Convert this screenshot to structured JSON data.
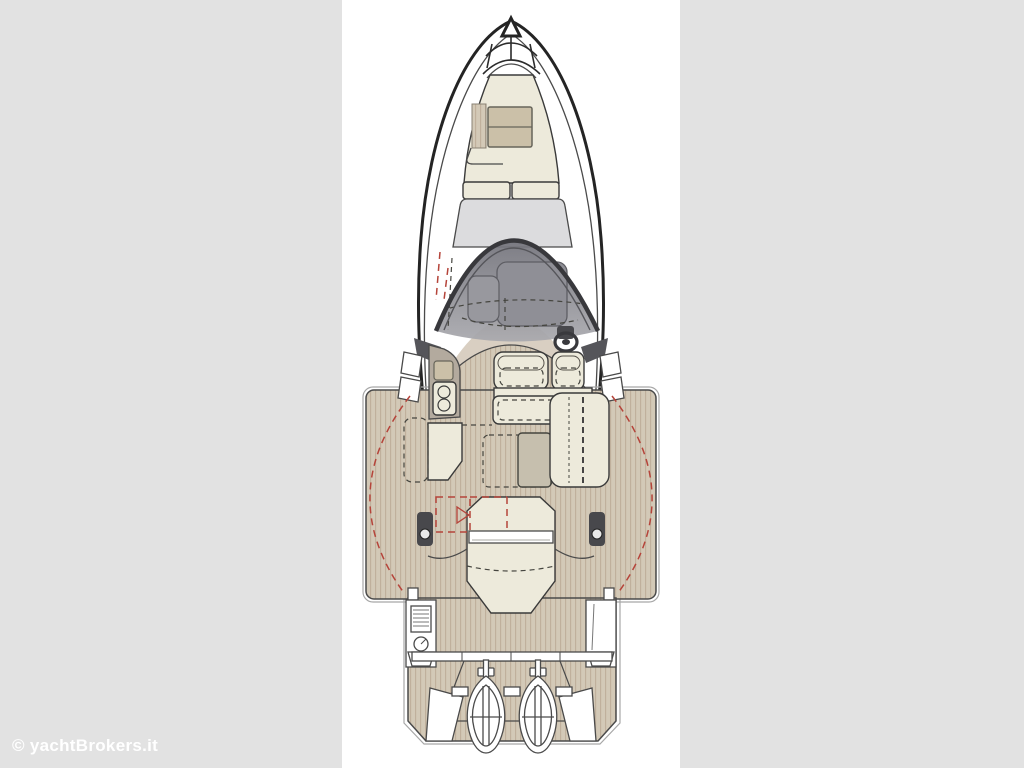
{
  "page": {
    "background": "#e2e2e2",
    "canvas_color": "#ffffff"
  },
  "watermark": {
    "text": "© yachtBrokers.it",
    "color": "#ffffff"
  },
  "palette": {
    "ink": "#242424",
    "inkSoft": "#4a4a4a",
    "teak": "#d3c9b7",
    "teakStripe": "#bfae9b",
    "teakEdge": "#a8a8a8",
    "cream": "#edeadb",
    "creamStroke": "#3a3a3a",
    "tan": "#cbc0a8",
    "tanStroke": "#67655a",
    "taupe": "#b3aa9e",
    "roofGray": "#dcdcde",
    "glassTop": "#73737b",
    "glassBottom": "#a9a9ae",
    "consoleGray": "#8f8f96",
    "consoleGray2": "#98989e",
    "consoleStroke": "#5e5e64",
    "dark": "#48484c",
    "tableGray": "#c6bfae",
    "beige": "#d9cfc2",
    "red": "#b5443a",
    "white": "#ffffff"
  },
  "diagram": {
    "type": "yacht deck plan, top view",
    "components": [
      "bow pulpit",
      "anchor locker",
      "bow sunpad",
      "bow hatch",
      "bow seatback",
      "cabin top",
      "wraparound windshield",
      "helm console",
      "steering wheel",
      "helm seats",
      "galley unit with sink and burners",
      "port cabinet",
      "cockpit table",
      "starboard bench",
      "side walkway",
      "mooring cleats",
      "aft sunpad with backrest",
      "canopy outline",
      "boarding consoles",
      "transom",
      "swim platform",
      "twin outboard engines"
    ]
  }
}
